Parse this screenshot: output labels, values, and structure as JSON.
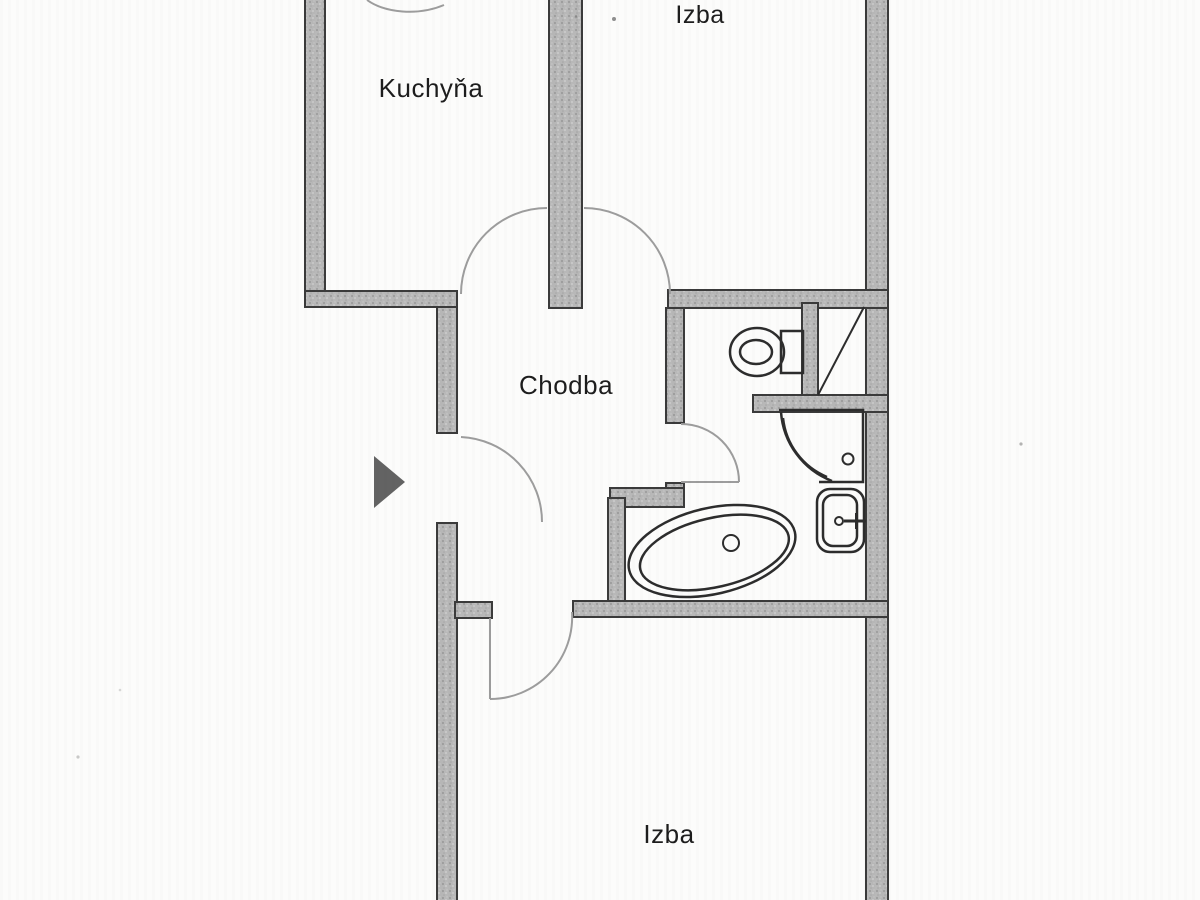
{
  "floor_plan": {
    "description": "Scanned apartment floor plan, cropped at top and bottom",
    "rooms": [
      {
        "name": "kitchen",
        "label": "Kuchyňa"
      },
      {
        "name": "room-top",
        "label": "Izba"
      },
      {
        "name": "hallway",
        "label": "Chodba"
      },
      {
        "name": "room-bottom",
        "label": "Izba"
      }
    ],
    "fixtures": [
      {
        "name": "toilet-with-cistern"
      },
      {
        "name": "installation-shaft-diagonal"
      },
      {
        "name": "corner-shower"
      },
      {
        "name": "washbasin-with-tap"
      },
      {
        "name": "oval-bathtub-with-drain"
      },
      {
        "name": "entrance-arrow"
      }
    ],
    "doors": [
      {
        "name": "kitchen-door-swing"
      },
      {
        "name": "room-top-door-swing"
      },
      {
        "name": "entrance-door-swing"
      },
      {
        "name": "bathroom-door-swing"
      },
      {
        "name": "room-bottom-door-swing"
      },
      {
        "name": "cropped-top-door-swing"
      }
    ],
    "colors": {
      "paper": "#fcfcfb",
      "wall_fill": "#b8b8b8",
      "wall_edge": "#3b3b3b",
      "fixture_line": "#2d2d2d",
      "door_arc": "#9d9d9d",
      "label_text": "#1d1d1d",
      "arrow": "#636363"
    }
  }
}
